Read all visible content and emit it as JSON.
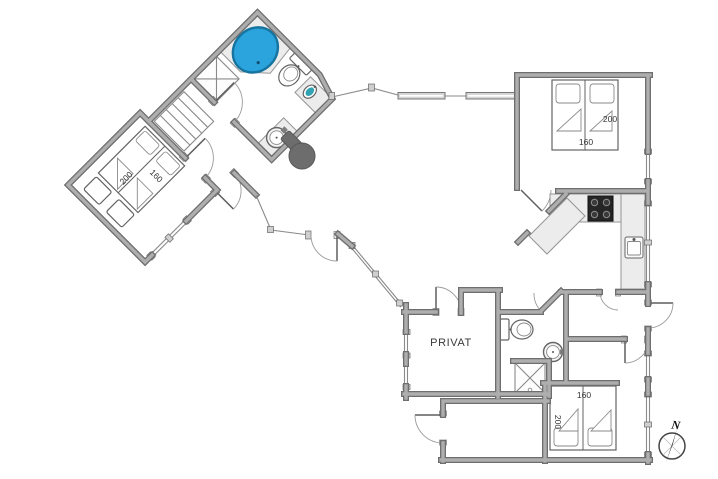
{
  "floorplan": {
    "labels": {
      "privat": "PRIVAT",
      "compass_north": "N"
    },
    "beds": {
      "left_bedroom": {
        "length": "200",
        "width": "160"
      },
      "top_right_bedroom": {
        "length": "200",
        "width": "160"
      },
      "bottom_right_bedroom": {
        "length": "200",
        "width": "160"
      }
    },
    "colors": {
      "spa_fill": "#2ba3dc",
      "spa_edge": "#16749f",
      "stove_fill": "#6d6d6d",
      "cooktop_fill": "#262626",
      "sink_teal": "#2fa3b4"
    }
  }
}
